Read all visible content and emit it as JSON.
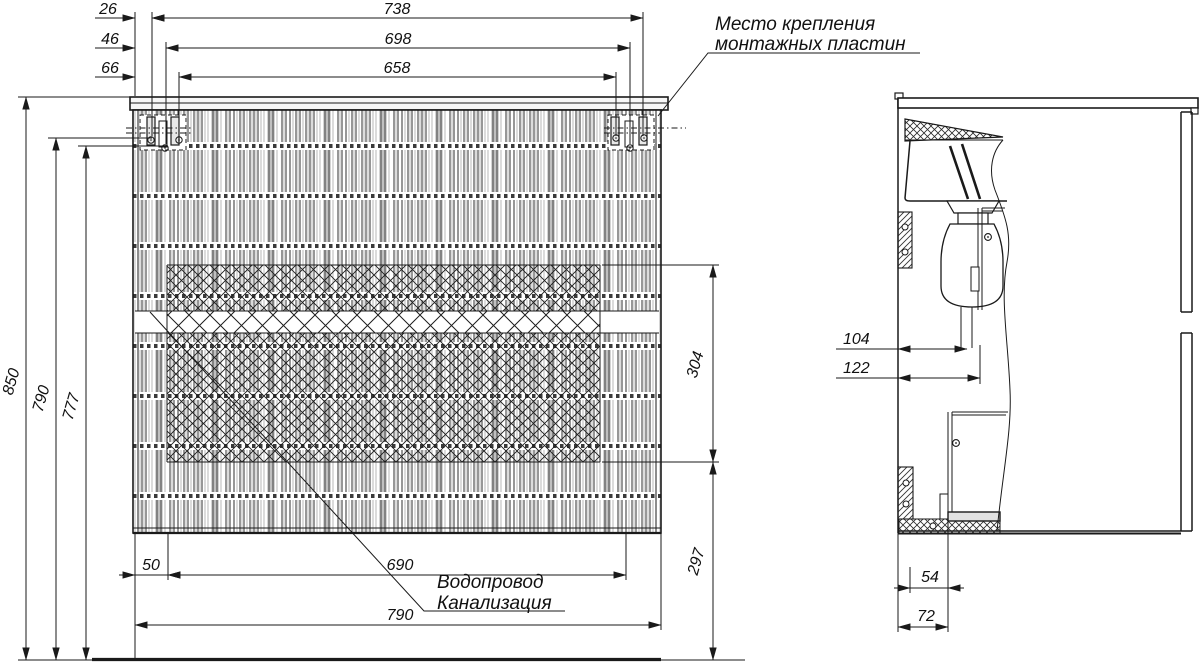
{
  "front_view": {
    "top_dims": {
      "offset_1": "26",
      "offset_2": "46",
      "offset_3": "66",
      "span_1": "738",
      "span_2": "698",
      "span_3": "658"
    },
    "left_dims": {
      "total_height": "850",
      "upper_mount_height": "790",
      "lower_mount_height": "777"
    },
    "right_dims": {
      "drawer_band_height": "304",
      "lower_height": "297"
    },
    "bottom_dims": {
      "edge_inset": "50",
      "inner_span": "690",
      "cabinet_width": "790"
    }
  },
  "side_view": {
    "dims": {
      "wall_to_drain": "104",
      "wall_to_drawer_back": "122",
      "bracket_to_drawer": "54",
      "wall_to_drawer_bottom": "72"
    }
  },
  "callouts": {
    "mounting_plates": {
      "line1": "Место крепления",
      "line2": "монтажных пластин"
    },
    "plumbing": {
      "line1": "Водопровод",
      "line2": "Канализация"
    }
  },
  "colors": {
    "line": "#1a1a1a",
    "background": "#ffffff",
    "texture": "#2f2f2f",
    "shade": "#d4d4d4"
  }
}
